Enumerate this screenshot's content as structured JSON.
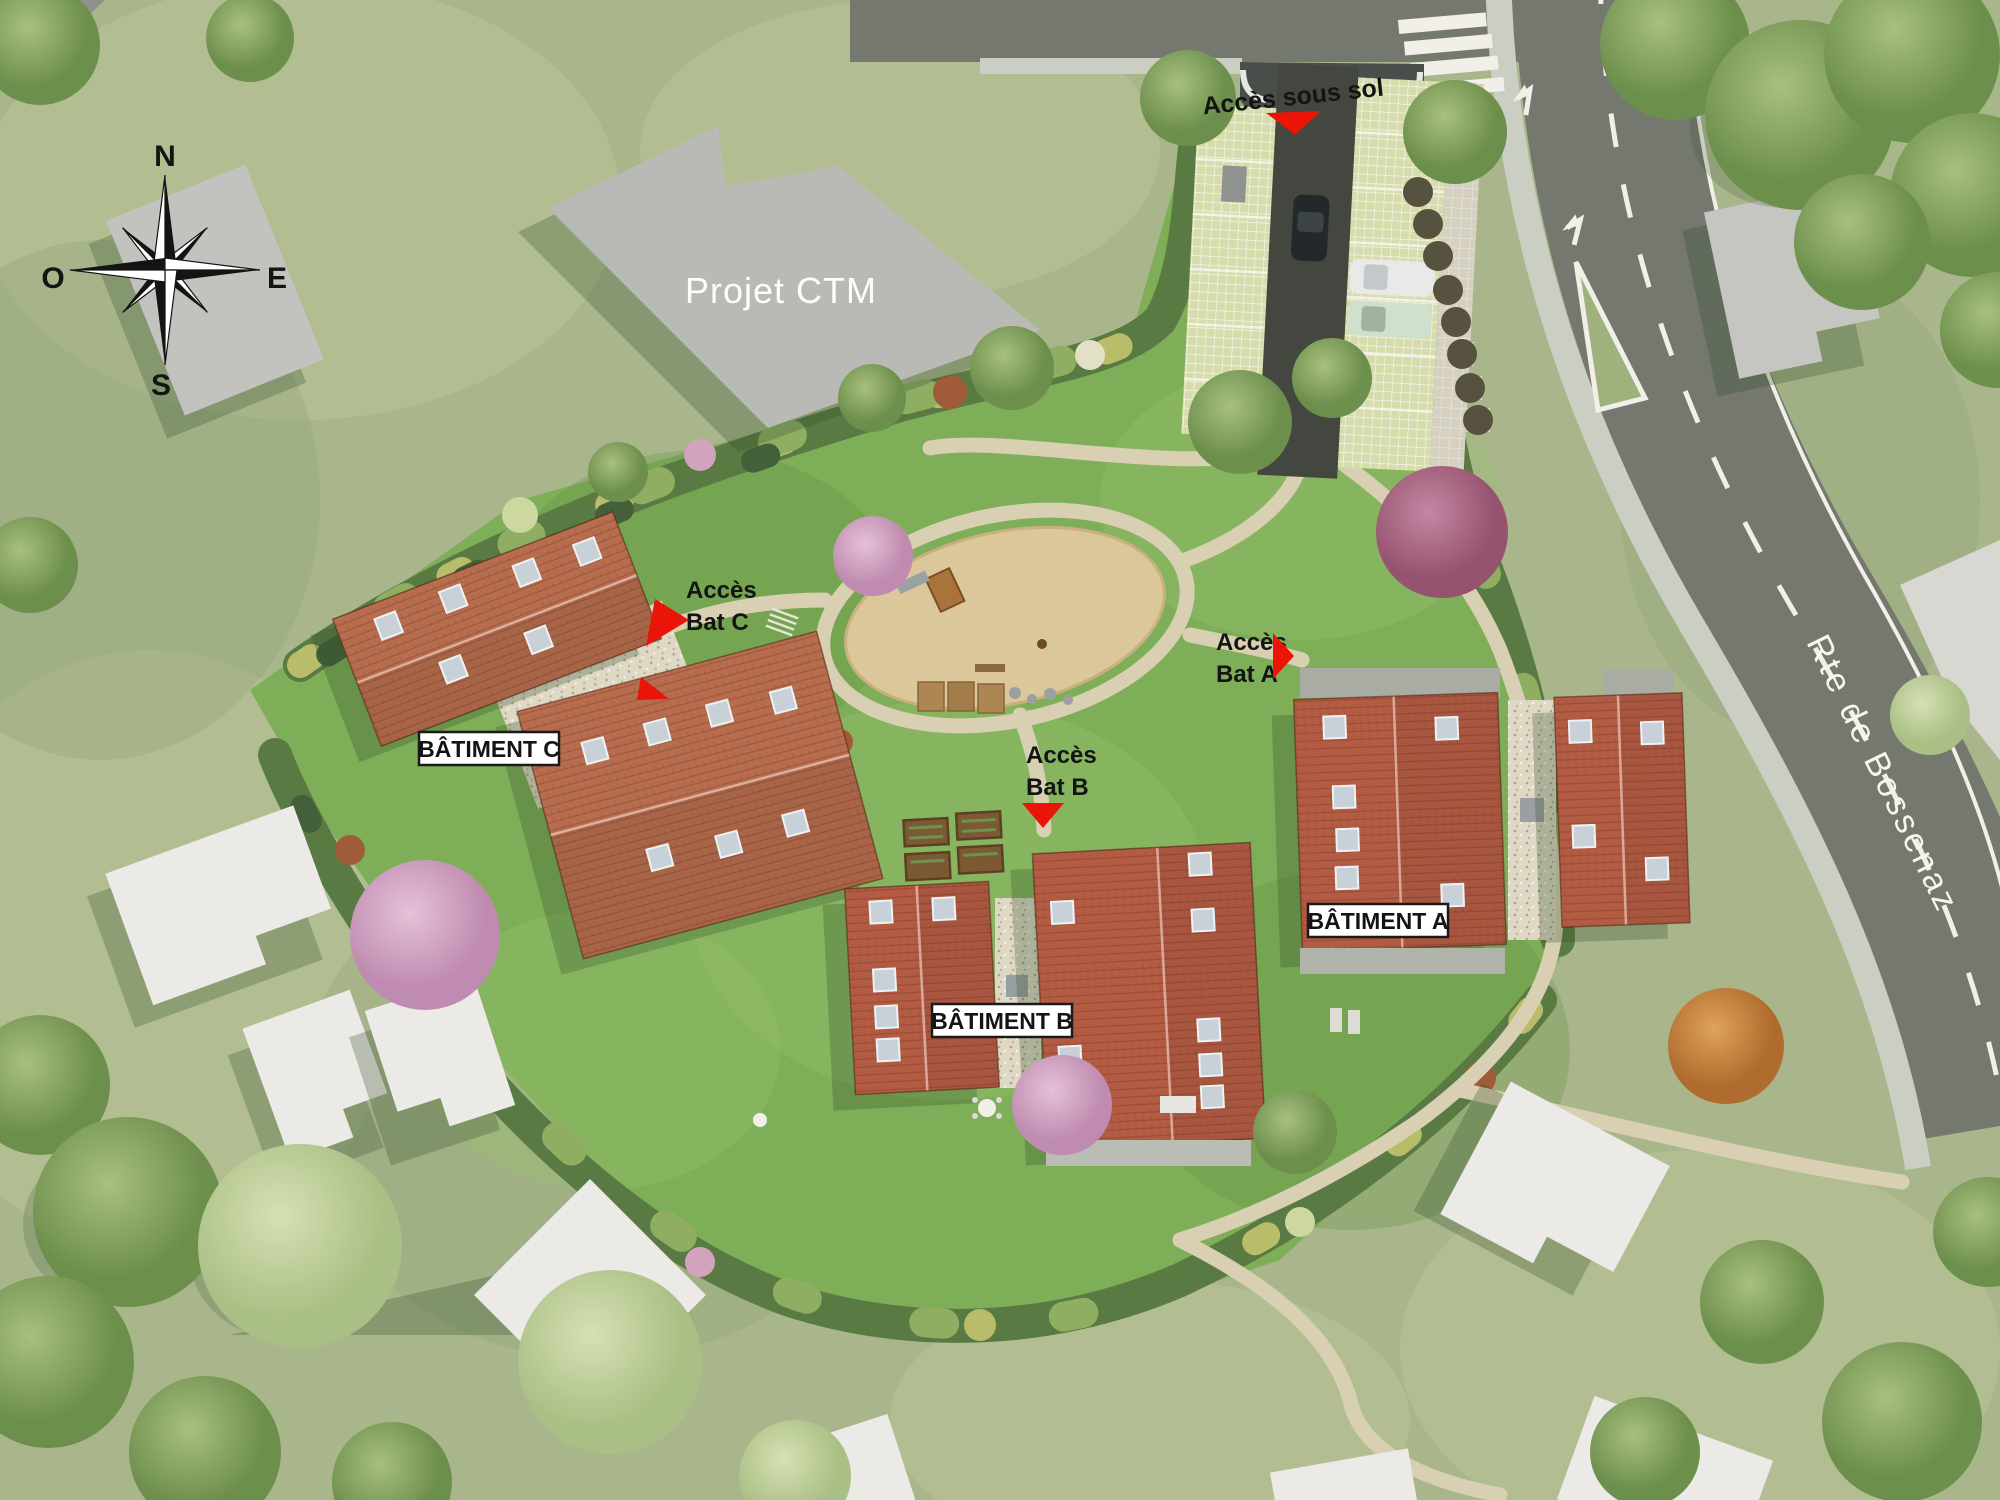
{
  "map": {
    "compass": {
      "n": "N",
      "e": "E",
      "s": "S",
      "o": "O"
    },
    "ctm_label": "Projet CTM",
    "street_name": "Rte de Bossenaz",
    "buildings": {
      "a": "BÂTIMENT A",
      "b": "BÂTIMENT B",
      "c": "BÂTIMENT C"
    },
    "access": {
      "sous_sol": {
        "label": "Accès sous sol"
      },
      "bat_a": {
        "line1": "Accès",
        "line2": "Bat A"
      },
      "bat_b": {
        "line1": "Accès",
        "line2": "Bat B"
      },
      "bat_c": {
        "line1": "Accès",
        "line2": "Bat C"
      }
    }
  },
  "colors": {
    "grass_outer": "#a9b68c",
    "grass_light": "#c2cd9e",
    "grass_site": "#7fae58",
    "hedge": "#5a7a43",
    "road": "#75786f",
    "asphalt": "#43473f",
    "sidewalk": "#cbcec2",
    "path": "#d9cfb2",
    "sand": "#dcc79a",
    "roof_c": "#b76d4e",
    "roof_ab": "#b35c43",
    "gravel": "#ded8c5",
    "paver": "#d6dcab",
    "gray_building": "#b9bab5",
    "white_building": "#eceae6",
    "shadow": "#2f4a28",
    "red": "#ea1508",
    "label_bg": "#ffffff",
    "ink": "#141414",
    "road_paint": "#f1efe7"
  }
}
